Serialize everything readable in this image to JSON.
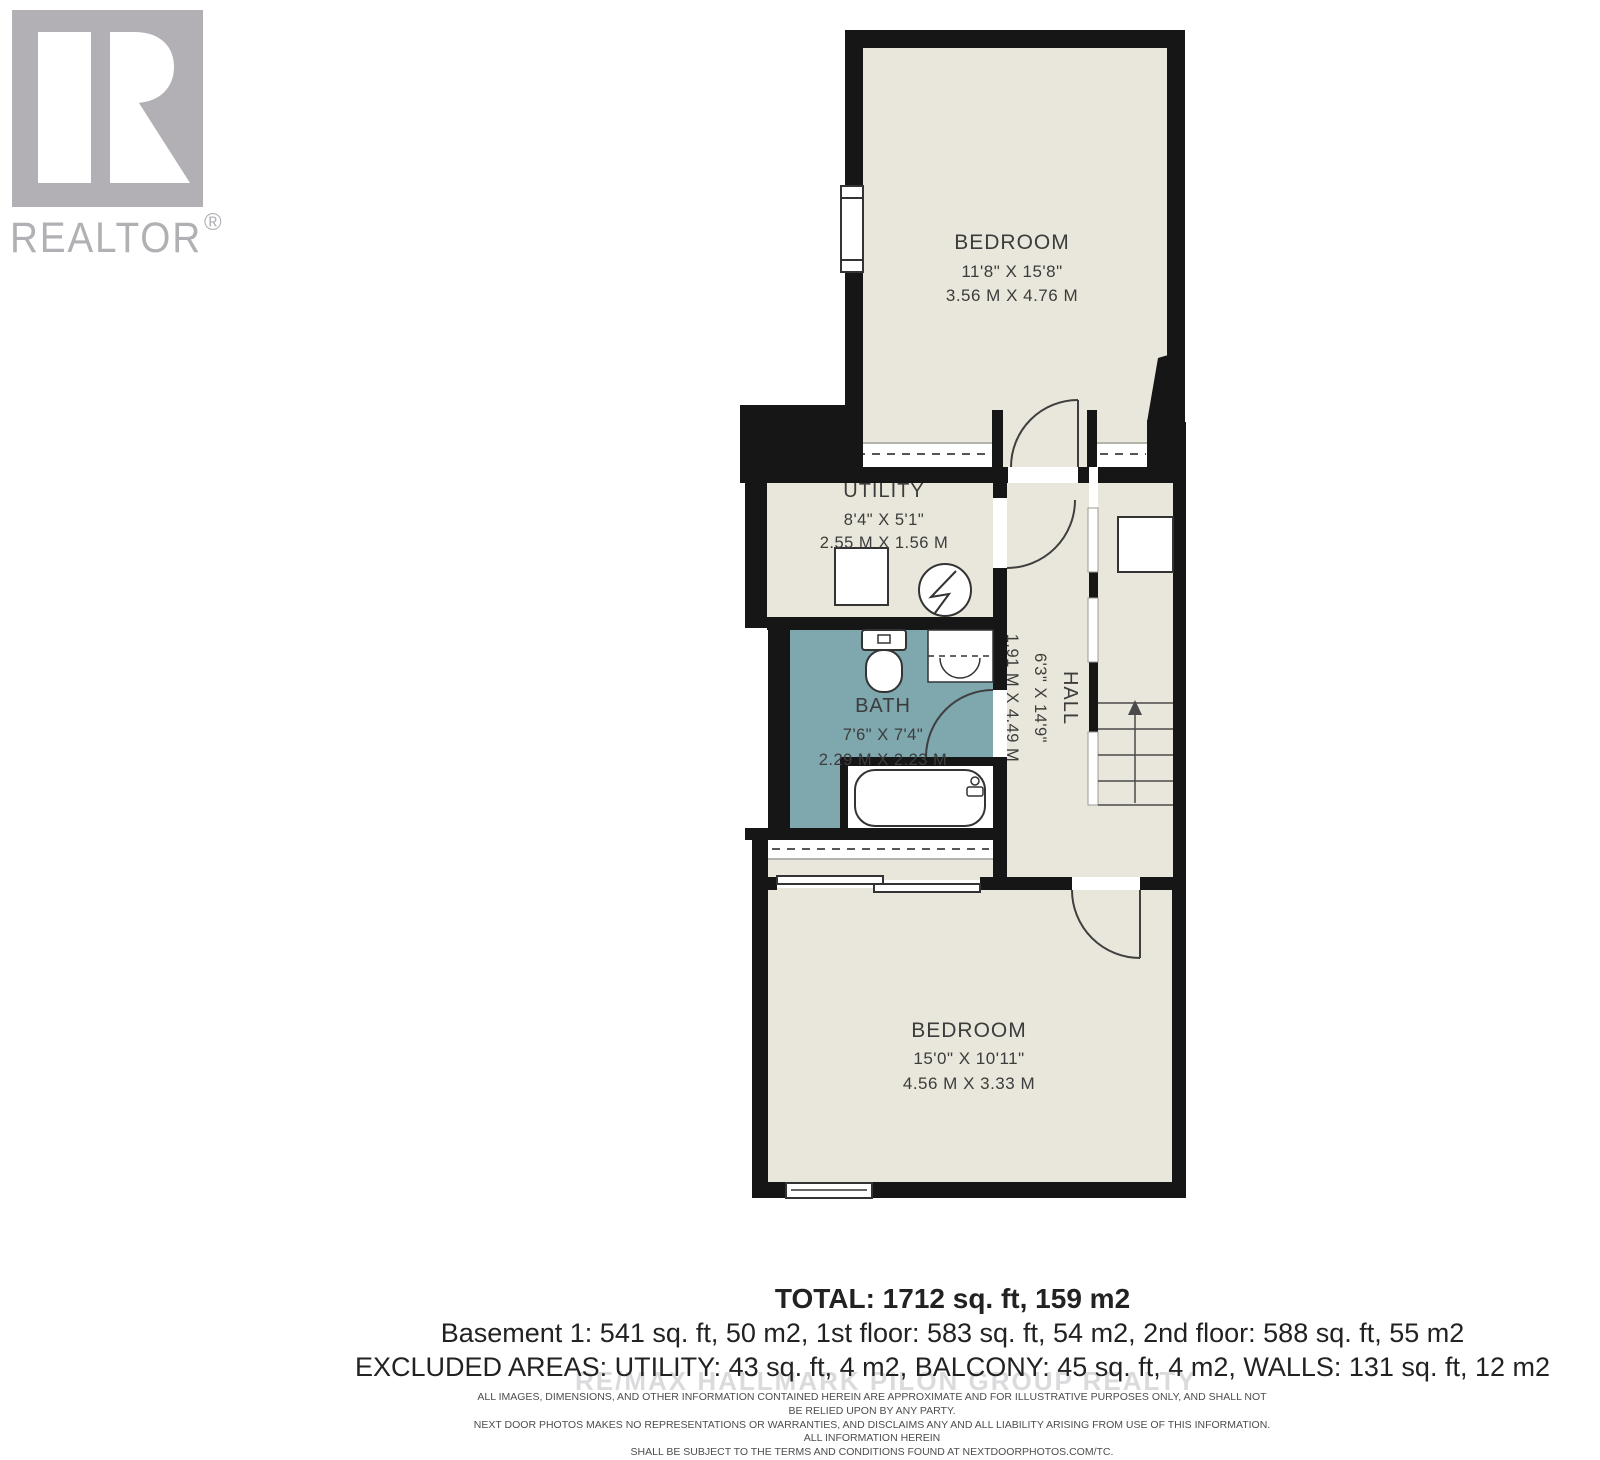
{
  "branding": {
    "logo_word": "REALTOR",
    "registered": "®"
  },
  "watermark": {
    "text": "RE/MAX HALLMARK PILON GROUP REALTY"
  },
  "floorplan": {
    "rooms": {
      "bedroom_top": {
        "name": "BEDROOM",
        "dims_ft": "11'8\" X 15'8\"",
        "dims_m": "3.56 M X 4.76 M"
      },
      "utility": {
        "name": "UTILITY",
        "dims_ft": "8'4\" X 5'1\"",
        "dims_m": "2.55 M X 1.56 M"
      },
      "bath": {
        "name": "BATH",
        "dims_ft": "7'6\" X 7'4\"",
        "dims_m": "2.29 M X 2.23 M"
      },
      "hall": {
        "name": "HALL",
        "dims_ft": "6'3\" X 14'9\"",
        "dims_m": "1.91 M X 4.49 M"
      },
      "bedroom_bottom": {
        "name": "BEDROOM",
        "dims_ft": "15'0\" X 10'11\"",
        "dims_m": "4.56 M X 3.33 M"
      }
    }
  },
  "summary": {
    "total": "TOTAL: 1712 sq. ft, 159 m2",
    "floors": "Basement 1: 541 sq. ft, 50 m2, 1st floor: 583 sq. ft, 54 m2, 2nd floor: 588 sq. ft, 55 m2",
    "excluded": "EXCLUDED AREAS: UTILITY: 43 sq. ft, 4 m2, BALCONY: 45 sq. ft, 4 m2, WALLS: 131 sq. ft, 12 m2"
  },
  "disclaimer": {
    "line1": "ALL IMAGES, DIMENSIONS, AND OTHER INFORMATION CONTAINED HEREIN ARE APPROXIMATE AND FOR ILLUSTRATIVE PURPOSES ONLY, AND SHALL NOT BE RELIED UPON BY ANY PARTY.",
    "line2": "NEXT DOOR PHOTOS MAKES NO REPRESENTATIONS OR WARRANTIES, AND DISCLAIMS ANY AND ALL LIABILITY ARISING FROM USE OF THIS INFORMATION. ALL INFORMATION HEREIN",
    "line3": "SHALL BE SUBJECT TO THE TERMS AND CONDITIONS FOUND AT NEXTDOORPHOTOS.COM/TC."
  },
  "colors": {
    "wall": "#161616",
    "floor": "#e9e7db",
    "bath_floor": "#7ea7ae",
    "label": "#3c3c3c",
    "logo_gray": "#b3b0b5",
    "watermark_gray": "#bfbdc2"
  }
}
